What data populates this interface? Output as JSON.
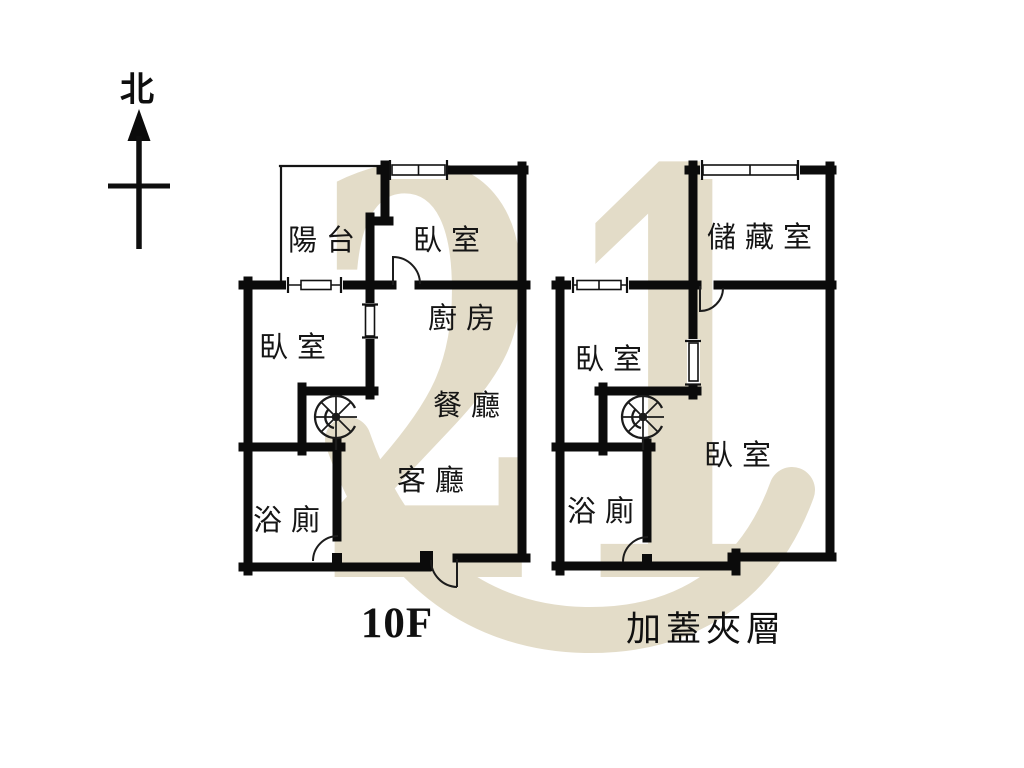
{
  "compass": {
    "north_label": "北"
  },
  "watermark": {
    "text": "21",
    "color": "#e3dcc8"
  },
  "units": {
    "left": {
      "caption": "10F",
      "rooms": {
        "balcony": "陽台",
        "bedroom_top": "臥室",
        "bedroom_side": "臥室",
        "kitchen": "廚房",
        "dining": "餐廳",
        "living": "客廳",
        "bathroom": "浴廁"
      }
    },
    "right": {
      "caption": "加蓋夾層",
      "rooms": {
        "storage": "儲藏室",
        "bedroom_small": "臥室",
        "bedroom_large": "臥室",
        "bathroom": "浴廁"
      }
    }
  },
  "colors": {
    "wall": "#0b0b0b",
    "label": "#151515",
    "kitchen_label": "#4b4535",
    "watermark": "#e3dcc8"
  }
}
